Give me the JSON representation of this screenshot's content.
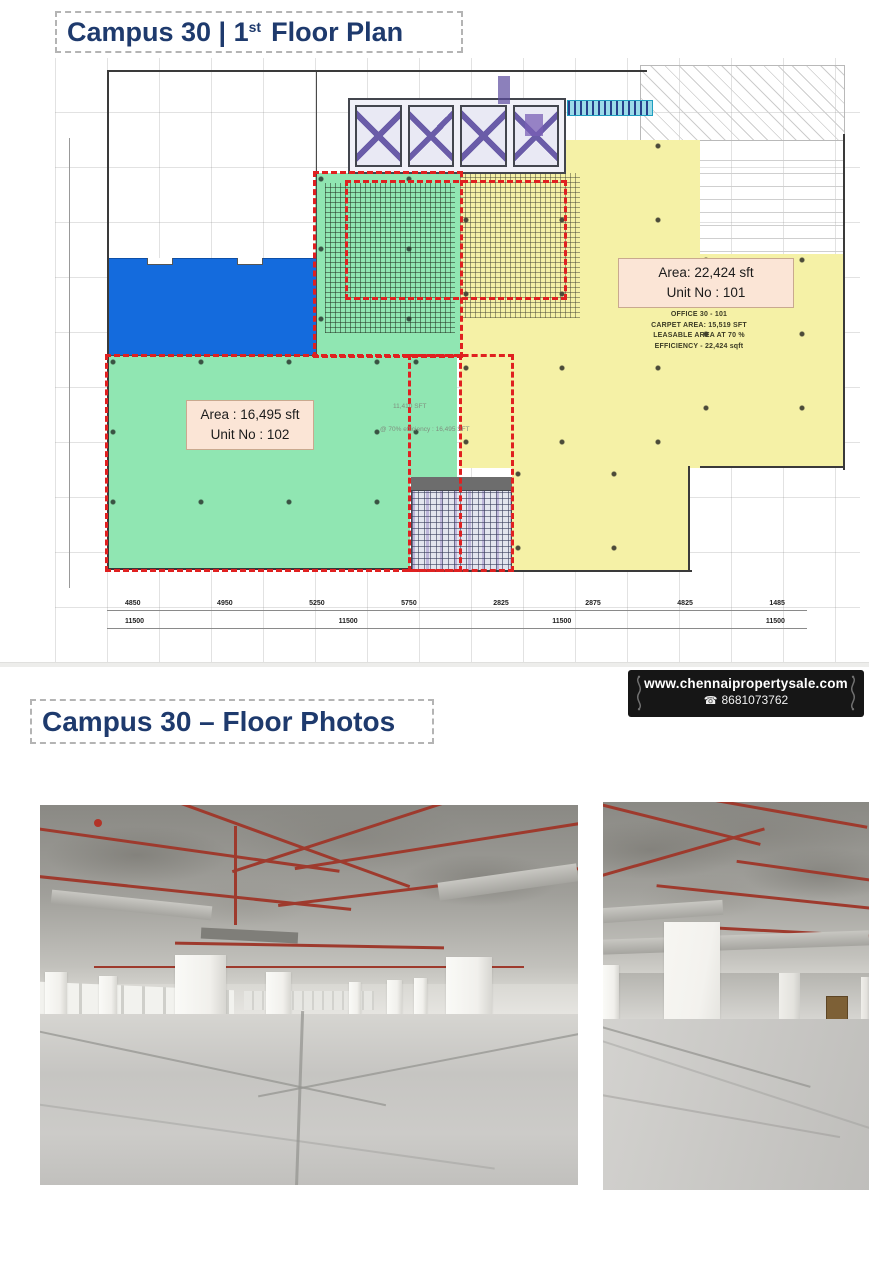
{
  "titles": {
    "plan": {
      "prefix": "Campus 30 | 1",
      "sup": "st",
      "suffix": "Floor Plan"
    },
    "photos": "Campus 30 – Floor Photos"
  },
  "plan": {
    "unit101": {
      "area": "Area: 22,424 sft",
      "unit": "Unit No : 101"
    },
    "unit102": {
      "area": "Area : 16,495 sft",
      "unit": "Unit No : 102"
    },
    "office_lines": [
      "OFFICE 30 - 101",
      "CARPET AREA: 15,519 SFT",
      "LEASABLE AREA AT 70 %",
      "EFFICIENCY - 22,424 sqft"
    ],
    "green_notes": [
      "11,410 SFT",
      "@ 70% efficiency : 16,495 SFT"
    ],
    "dims_row1": [
      "4850",
      "4950",
      "5250",
      "5750",
      "2825",
      "2875",
      "4825",
      "1485"
    ],
    "dims_row2": [
      "11500",
      "11500",
      "11500",
      "11500"
    ],
    "colors": {
      "unit101_fill": "#f5f1a6",
      "unit102_fill": "#90e6b2",
      "highlight_blue": "#146bdd",
      "boundary_red": "#e02020",
      "label_bg": "#fbe5d6",
      "title_navy": "#1e3a6d"
    }
  },
  "badge": {
    "website": "www.chennaipropertysale.com",
    "phone": "8681073762",
    "phone_icon_glyph": "☎"
  }
}
